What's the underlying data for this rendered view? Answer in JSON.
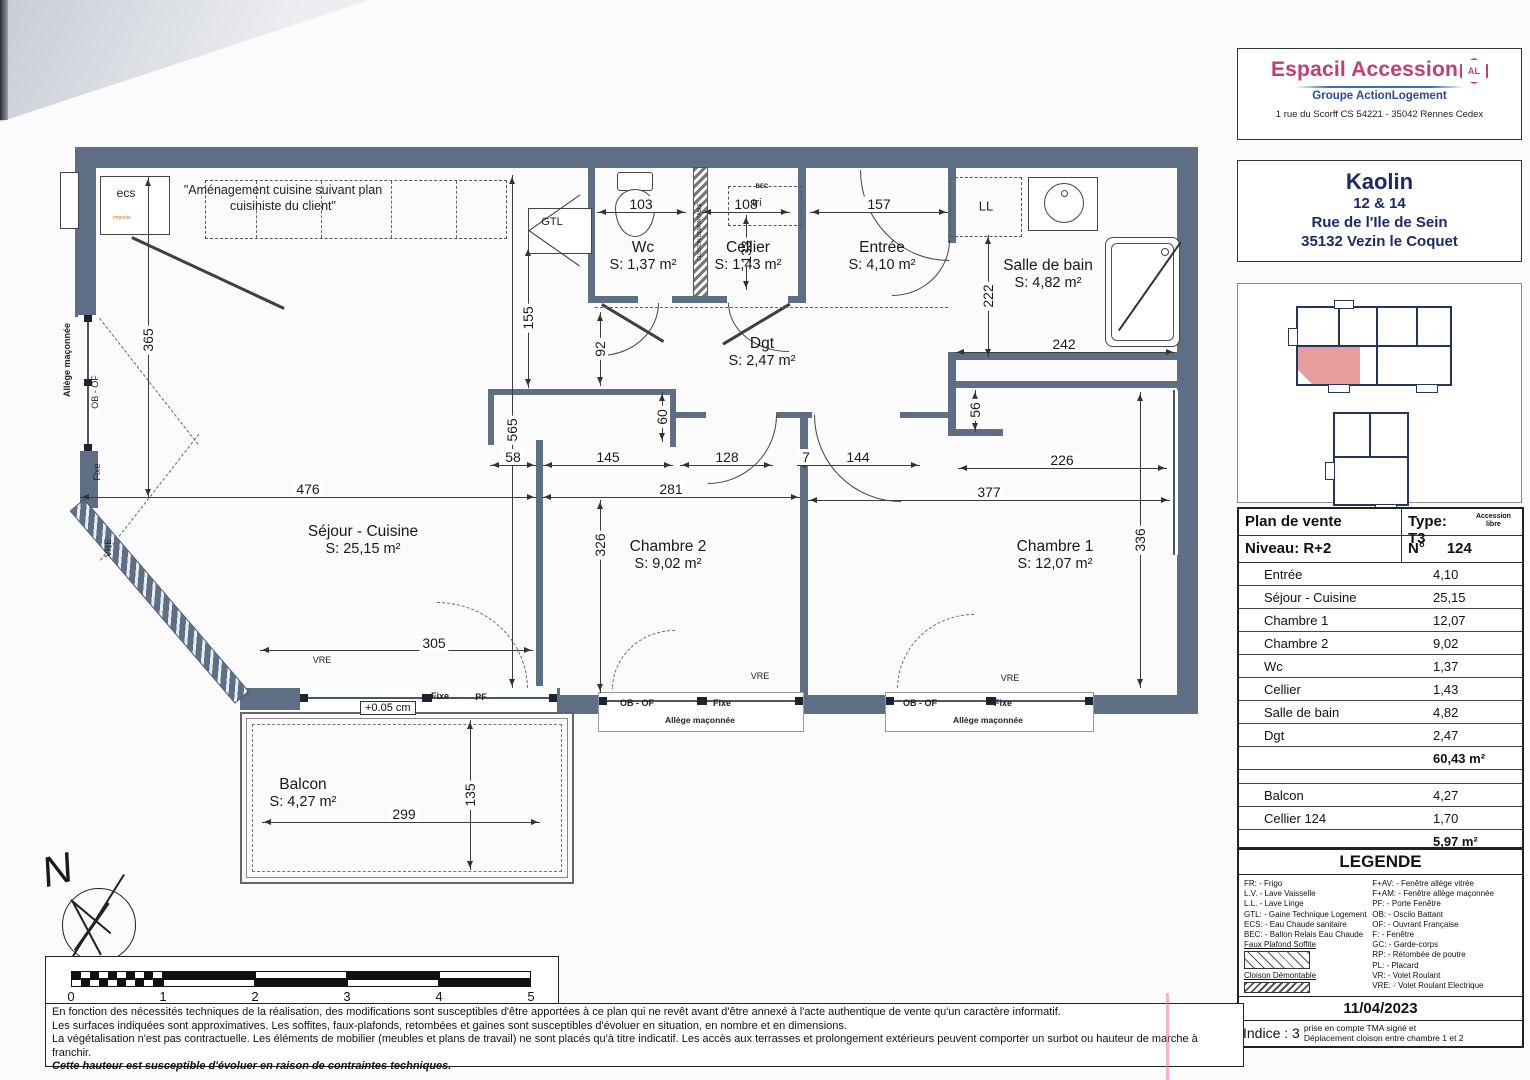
{
  "agency": {
    "name": "Espacil Accession",
    "badge": "AL",
    "group": "Groupe ActionLogement",
    "address": "1 rue du Scorff  CS 54221 - 35042 Rennes Cedex"
  },
  "project": {
    "name": "Kaolin",
    "numbers": "12 & 14",
    "street": "Rue de l'Ile de Sein",
    "city": "35132 Vezin le Coquet"
  },
  "sale_table": {
    "title": "Plan de vente",
    "type_label": "Type:  T3",
    "type_note": "Accession libre",
    "level_label": "Niveau:    R+2",
    "unit_label": "N°",
    "unit_value": "124",
    "rooms": [
      {
        "label": "Entrée",
        "value": "4,10"
      },
      {
        "label": "Séjour - Cuisine",
        "value": "25,15"
      },
      {
        "label": "Chambre 1",
        "value": "12,07"
      },
      {
        "label": "Chambre 2",
        "value": "9,02"
      },
      {
        "label": "Wc",
        "value": "1,37"
      },
      {
        "label": "Cellier",
        "value": "1,43"
      },
      {
        "label": "Salle de bain",
        "value": "4,82"
      },
      {
        "label": "Dgt",
        "value": "2,47"
      }
    ],
    "total": "60,43 m²",
    "annexes": [
      {
        "label": "Balcon",
        "value": "4,27"
      },
      {
        "label": "Cellier 124",
        "value": "1,70"
      }
    ],
    "annex_total": "5,97 m²"
  },
  "legend": {
    "title": "LEGENDE",
    "left": [
      "FR: - Frigo",
      "L.V. - Lave Vaisselle",
      "L.L. - Lave Linge",
      "GTL: - Gaine Technique Logement",
      "ECS: - Eau Chaude sanitaire",
      "BEC: - Ballon Relais Eau Chaude"
    ],
    "sample1": "Faux Plafond Soffite",
    "sample2": "Cloison Démontable",
    "right": [
      "F+AV: - Fenêtre allège vitrée",
      "F+AM: - Fenêtre allège maçonnée",
      "PF: - Porte Fenêtre",
      "OB: - Oscilo Battant",
      "OF: - Ouvrant Française",
      "F: - Fenêtre",
      "GC: - Garde-corps",
      "RP: - Rétombée de poutre",
      "PL: - Placard",
      "VR: - Volet Roulant",
      "VRE: - Volet Roulant Electrique"
    ],
    "date": "11/04/2023",
    "indice_label": "Indice : 3",
    "indice_note_1": "prise en compte TMA signé et",
    "indice_note_2": "Déplacement cloison entre chambre 1 et 2"
  },
  "plan": {
    "kitchen_note_1": "\"Aménagement cuisine suivant plan",
    "kitchen_note_2": "cuisiniste du client\"",
    "level_mark": "+0.05 cm",
    "rooms": [
      {
        "name": "Wc",
        "area": "S: 1,37 m²",
        "x": 643,
        "y": 256
      },
      {
        "name": "Cellier",
        "area": "S: 1,43 m²",
        "x": 748,
        "y": 256
      },
      {
        "name": "Entrée",
        "area": "S: 4,10 m²",
        "x": 882,
        "y": 256
      },
      {
        "name": "Salle de bain",
        "area": "S: 4,82 m²",
        "x": 1048,
        "y": 274
      },
      {
        "name": "Dgt",
        "area": "S: 2,47 m²",
        "x": 762,
        "y": 352
      },
      {
        "name": "Séjour - Cuisine",
        "area": "S: 25,15 m²",
        "x": 363,
        "y": 540
      },
      {
        "name": "Chambre 2",
        "area": "S: 9,02 m²",
        "x": 668,
        "y": 555
      },
      {
        "name": "Chambre 1",
        "area": "S: 12,07 m²",
        "x": 1055,
        "y": 555
      },
      {
        "name": "Balcon",
        "area": "S: 4,27 m²",
        "x": 303,
        "y": 793
      }
    ],
    "dims": [
      {
        "t": "103",
        "x": 641,
        "y": 204
      },
      {
        "t": "108",
        "x": 746,
        "y": 204
      },
      {
        "t": "157",
        "x": 879,
        "y": 204
      },
      {
        "t": "133",
        "x": 746,
        "y": 252,
        "v": 1
      },
      {
        "t": "222",
        "x": 988,
        "y": 296,
        "v": 1
      },
      {
        "t": "242",
        "x": 1064,
        "y": 344
      },
      {
        "t": "365",
        "x": 148,
        "y": 340,
        "v": 1
      },
      {
        "t": "155",
        "x": 528,
        "y": 318,
        "v": 1
      },
      {
        "t": "92",
        "x": 600,
        "y": 349,
        "v": 1
      },
      {
        "t": "565",
        "x": 512,
        "y": 430,
        "v": 1
      },
      {
        "t": "60",
        "x": 662,
        "y": 417,
        "v": 1
      },
      {
        "t": "58",
        "x": 513,
        "y": 457
      },
      {
        "t": "145",
        "x": 608,
        "y": 457
      },
      {
        "t": "128",
        "x": 727,
        "y": 457
      },
      {
        "t": "7",
        "x": 806,
        "y": 457
      },
      {
        "t": "144",
        "x": 858,
        "y": 457
      },
      {
        "t": "226",
        "x": 1062,
        "y": 460
      },
      {
        "t": "476",
        "x": 308,
        "y": 489
      },
      {
        "t": "281",
        "x": 671,
        "y": 489
      },
      {
        "t": "377",
        "x": 989,
        "y": 492
      },
      {
        "t": "56",
        "x": 975,
        "y": 410,
        "v": 1
      },
      {
        "t": "326",
        "x": 600,
        "y": 545,
        "v": 1
      },
      {
        "t": "336",
        "x": 1140,
        "y": 540,
        "v": 1
      },
      {
        "t": "305",
        "x": 434,
        "y": 643
      },
      {
        "t": "135",
        "x": 470,
        "y": 795,
        "v": 1
      },
      {
        "t": "299",
        "x": 404,
        "y": 814
      }
    ],
    "tags": [
      {
        "t": "ecs",
        "x": 126,
        "y": 193,
        "s": 12
      },
      {
        "t": "imposte",
        "x": 122,
        "y": 218,
        "s": 5,
        "c": "#c07a2e"
      },
      {
        "t": "GTL",
        "x": 552,
        "y": 222,
        "s": 11
      },
      {
        "t": "BEC",
        "x": 762,
        "y": 187,
        "s": 6,
        "b": 1
      },
      {
        "t": "tri",
        "x": 757,
        "y": 203,
        "s": 11
      },
      {
        "t": "CLOISON DEMONTABLE",
        "x": 700,
        "y": 232,
        "s": 5,
        "r": -90
      },
      {
        "t": "LL",
        "x": 986,
        "y": 206,
        "s": 13
      },
      {
        "t": "Allège maçonnée",
        "x": 67,
        "y": 360,
        "s": 9,
        "r": -90,
        "b": 1
      },
      {
        "t": "OB - OF",
        "x": 95,
        "y": 392,
        "s": 9,
        "r": -90
      },
      {
        "t": "Fixe",
        "x": 97,
        "y": 472,
        "s": 9,
        "r": -90
      },
      {
        "t": "VRE",
        "x": 108,
        "y": 548,
        "s": 9,
        "r": -90
      },
      {
        "t": "VRE",
        "x": 322,
        "y": 660,
        "s": 9
      },
      {
        "t": "Fixe",
        "x": 440,
        "y": 696,
        "s": 9,
        "b": 1
      },
      {
        "t": "PF",
        "x": 481,
        "y": 697,
        "s": 9,
        "b": 1
      },
      {
        "t": "OB - OF",
        "x": 637,
        "y": 703,
        "s": 9,
        "b": 1
      },
      {
        "t": "Fixe",
        "x": 722,
        "y": 703,
        "s": 9,
        "b": 1
      },
      {
        "t": "Allège maçonnée",
        "x": 700,
        "y": 720,
        "s": 8.5,
        "b": 1
      },
      {
        "t": "VRE",
        "x": 760,
        "y": 676,
        "s": 9
      },
      {
        "t": "OB - OF",
        "x": 920,
        "y": 703,
        "s": 9,
        "b": 1
      },
      {
        "t": "Fixe",
        "x": 1003,
        "y": 703,
        "s": 9,
        "b": 1
      },
      {
        "t": "Allège maçonnée",
        "x": 988,
        "y": 720,
        "s": 8.5,
        "b": 1
      },
      {
        "t": "VRE",
        "x": 1010,
        "y": 678,
        "s": 9
      }
    ]
  },
  "scalebar": {
    "ticks": [
      "0",
      "1",
      "2",
      "3",
      "4",
      "5"
    ]
  },
  "footer": {
    "lines": [
      "En fonction des nécessités techniques de la réalisation, des modifications sont susceptibles d'être apportées à ce plan qui ne revêt avant d'être annexé à l'acte authentique de vente qu'un caractère informatif.",
      "Les surfaces indiquées sont approximatives. Les soffites, faux-plafonds, retombées et gaines sont susceptibles d'évoluer en situation, en nombre et en dimensions.",
      "La végétalisation n'est pas contractuelle. Les éléments de mobilier (meubles et plans de travail) ne sont placés qu'à titre indicatif. Les accès aux terrasses et prolongement extérieurs peuvent comporter un surbot ou hauteur de marche à franchir.",
      "Cette hauteur est susceptible d'évoluer en raison de contraintes techniques."
    ]
  }
}
